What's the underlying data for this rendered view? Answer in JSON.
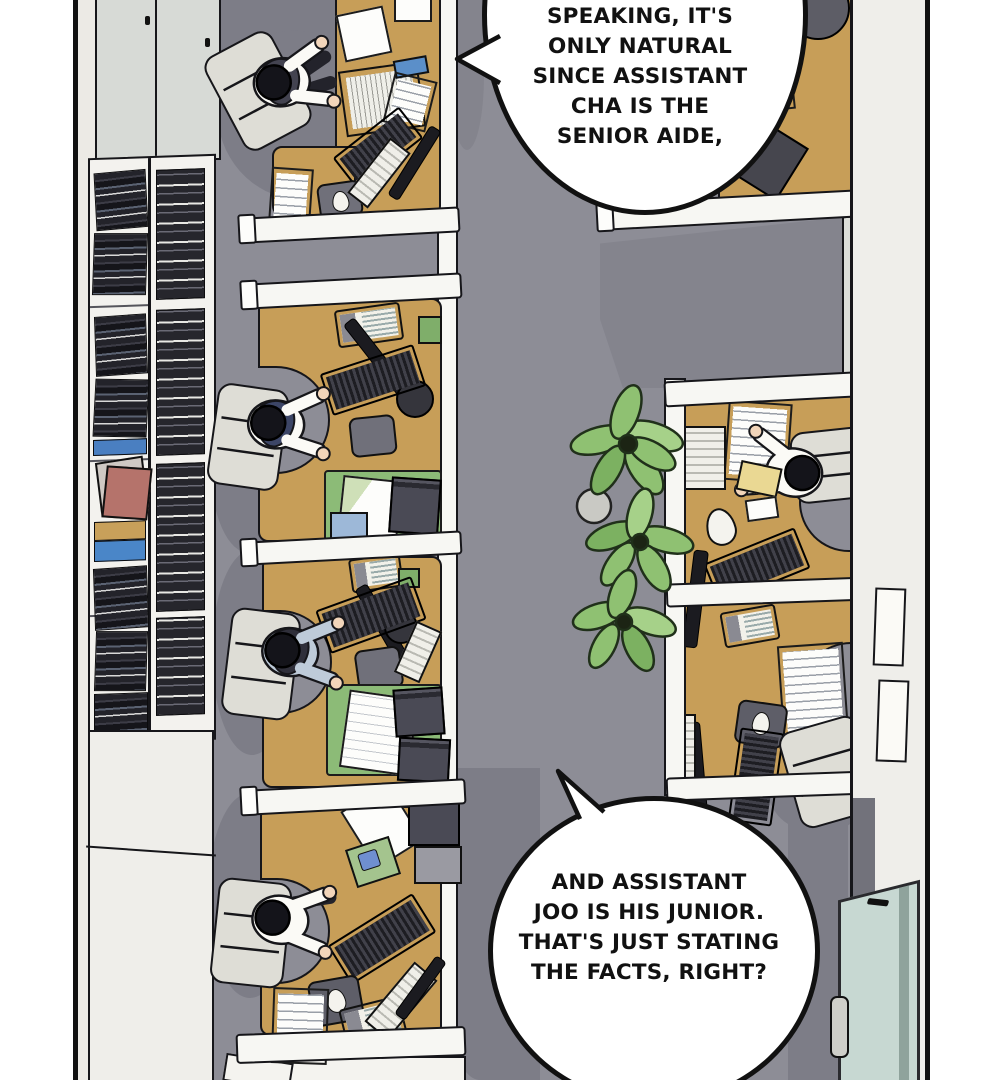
{
  "panel_type": "webtoon-comic-panel-office-topdown",
  "bubbles": {
    "top": {
      "lines": [
        "SPEAKING, IT'S",
        "ONLY NATURAL",
        "SINCE ASSISTANT",
        "CHA IS THE",
        "SENIOR AIDE,"
      ]
    },
    "bottom": {
      "lines": [
        "AND ASSISTANT",
        "JOO IS HIS JUNIOR.",
        "THAT'S JUST STATING",
        "THE FACTS, RIGHT?"
      ]
    }
  },
  "scene": {
    "description_objects": [
      "bookshelf",
      "office-cubicles",
      "workers-at-desks",
      "office-plants",
      "glass-door"
    ],
    "worker_count": 5
  },
  "colors": {
    "floor": "#8d8d96",
    "floor_shadow": "#7d7d87",
    "wall": "#efeeea",
    "partition": "#f7f7f3",
    "desk": "#c79e58",
    "chair": "#deddd6",
    "vest": "#434350",
    "shirt_white": "#fbfaf6",
    "shirt_blue": "#becbd9",
    "skin": "#f2d5ba",
    "green_desk_mat": "#8cbb77",
    "plant_green": "#8fc172",
    "glass_door": "#c7d8d2",
    "folder_yellow": "#ead893",
    "book_blue": "#4a7fc1",
    "book_red": "#b5736b",
    "outline": "#16161a"
  }
}
